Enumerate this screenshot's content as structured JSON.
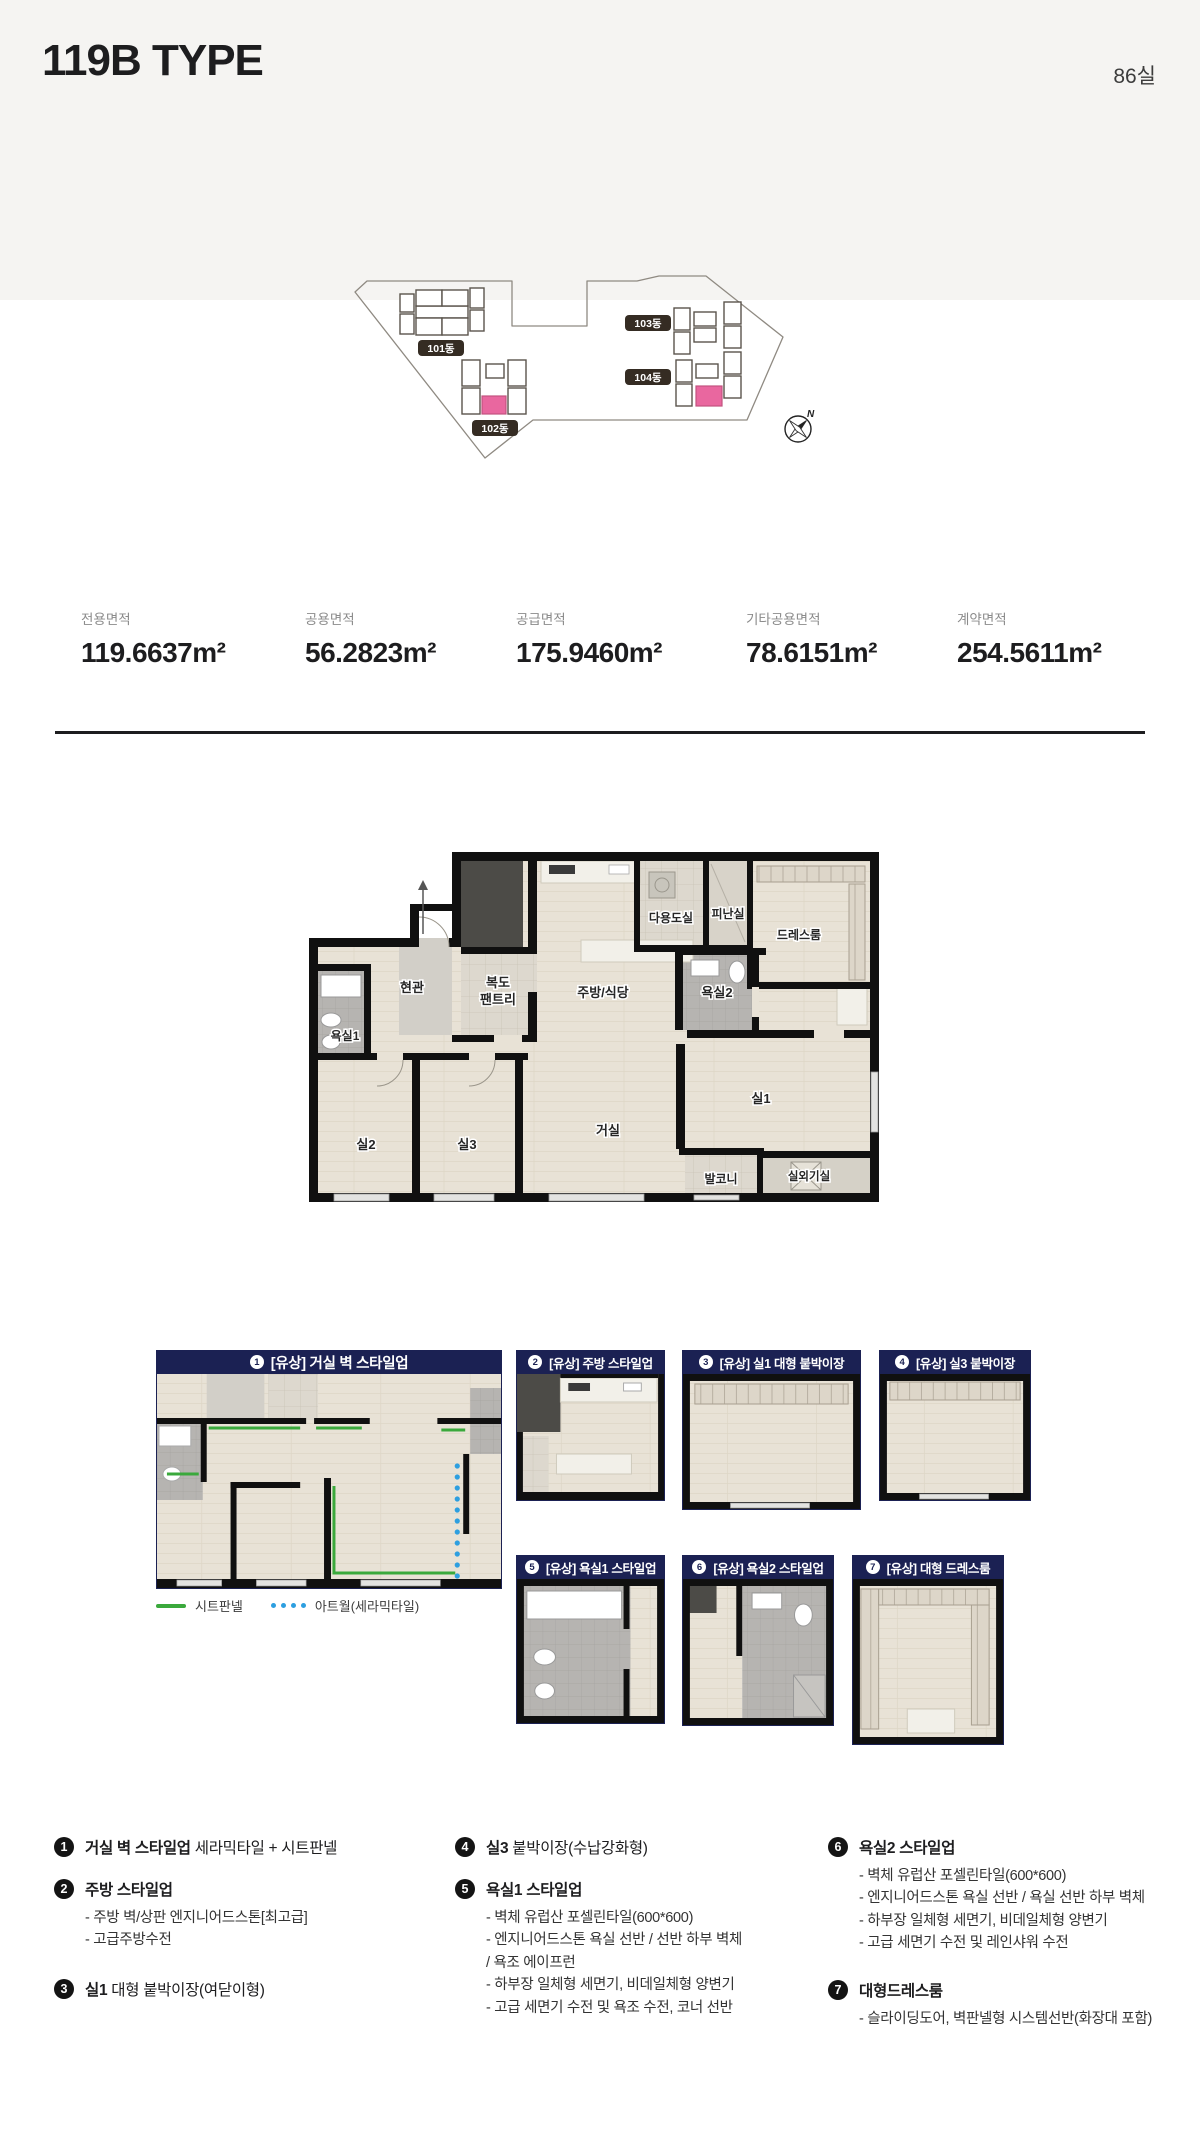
{
  "page": {
    "title": "119B TYPE",
    "unit_count": "86실"
  },
  "site_plan": {
    "labels": {
      "b101": "101동",
      "b102": "102동",
      "b103": "103동",
      "b104": "104동"
    },
    "compass": "N",
    "highlight_color": "#e9679f"
  },
  "areas": [
    {
      "label": "전용면적",
      "value": "119.6637m²"
    },
    {
      "label": "공용면적",
      "value": "56.2823m²"
    },
    {
      "label": "공급면적",
      "value": "175.9460m²"
    },
    {
      "label": "기타공용면적",
      "value": "78.6151m²"
    },
    {
      "label": "계약면적",
      "value": "254.5611m²"
    }
  ],
  "floor_plan": {
    "rooms": {
      "entrance": "현관",
      "corridor": "복도",
      "pantry": "팬트리",
      "kitchen": "주방/식당",
      "utility": "다용도실",
      "refuge": "피난실",
      "dressroom": "드레스룸",
      "bath2": "욕실2",
      "bath1": "욕실1",
      "room2": "실2",
      "room3": "실3",
      "living": "거실",
      "room1": "실1",
      "balcony": "발코니",
      "outdoor_unit": "실외기실"
    }
  },
  "options": {
    "panels": [
      {
        "num": "1",
        "title": "[유상] 거실 벽 스타일업"
      },
      {
        "num": "2",
        "title": "[유상] 주방 스타일업"
      },
      {
        "num": "3",
        "title": "[유상] 실1 대형 붙박이장"
      },
      {
        "num": "4",
        "title": "[유상] 실3 붙박이장"
      },
      {
        "num": "5",
        "title": "[유상] 욕실1 스타일업"
      },
      {
        "num": "6",
        "title": "[유상] 욕실2 스타일업"
      },
      {
        "num": "7",
        "title": "[유상] 대형 드레스룸"
      }
    ],
    "legend": [
      {
        "label": "시트판넬",
        "color": "#3aa93c"
      },
      {
        "label": "아트월(세라믹타일)",
        "color": "#2d9fe0"
      }
    ]
  },
  "details": {
    "col1": [
      {
        "num": "1",
        "bold": "거실 벽 스타일업",
        "rest": " 세라믹타일 + 시트판넬",
        "subs": []
      },
      {
        "num": "2",
        "bold": "주방 스타일업",
        "rest": "",
        "subs": [
          "- 주방 벽/상판 엔지니어드스톤[최고급]",
          "- 고급주방수전"
        ]
      },
      {
        "num": "3",
        "bold": "실1",
        "rest": " 대형 붙박이장(여닫이형)",
        "subs": []
      }
    ],
    "col2": [
      {
        "num": "4",
        "bold": "실3",
        "rest": " 붙박이장(수납강화형)",
        "subs": []
      },
      {
        "num": "5",
        "bold": "욕실1 스타일업",
        "rest": "",
        "subs": [
          "- 벽체 유럽산 포셀린타일(600*600)",
          "- 엔지니어드스톤 욕실 선반 / 선반 하부 벽체",
          "/ 욕조 에이프런",
          "- 하부장 일체형 세면기, 비데일체형 양변기",
          "- 고급 세면기 수전 및 욕조 수전, 코너 선반"
        ]
      }
    ],
    "col3": [
      {
        "num": "6",
        "bold": "욕실2 스타일업",
        "rest": "",
        "subs": [
          "- 벽체 유럽산 포셀린타일(600*600)",
          "- 엔지니어드스톤 욕실 선반 / 욕실 선반 하부 벽체",
          "- 하부장 일체형 세면기, 비데일체형 양변기",
          "- 고급 세면기 수전 및 레인샤워 수전"
        ]
      },
      {
        "num": "7",
        "bold": "대형드레스룸",
        "rest": "",
        "subs": [
          "- 슬라이딩도어, 벽판넬형 시스템선반(화장대 포함)"
        ]
      }
    ]
  },
  "colors": {
    "accent_navy": "#1b2153",
    "badge_dark": "#352c23"
  }
}
